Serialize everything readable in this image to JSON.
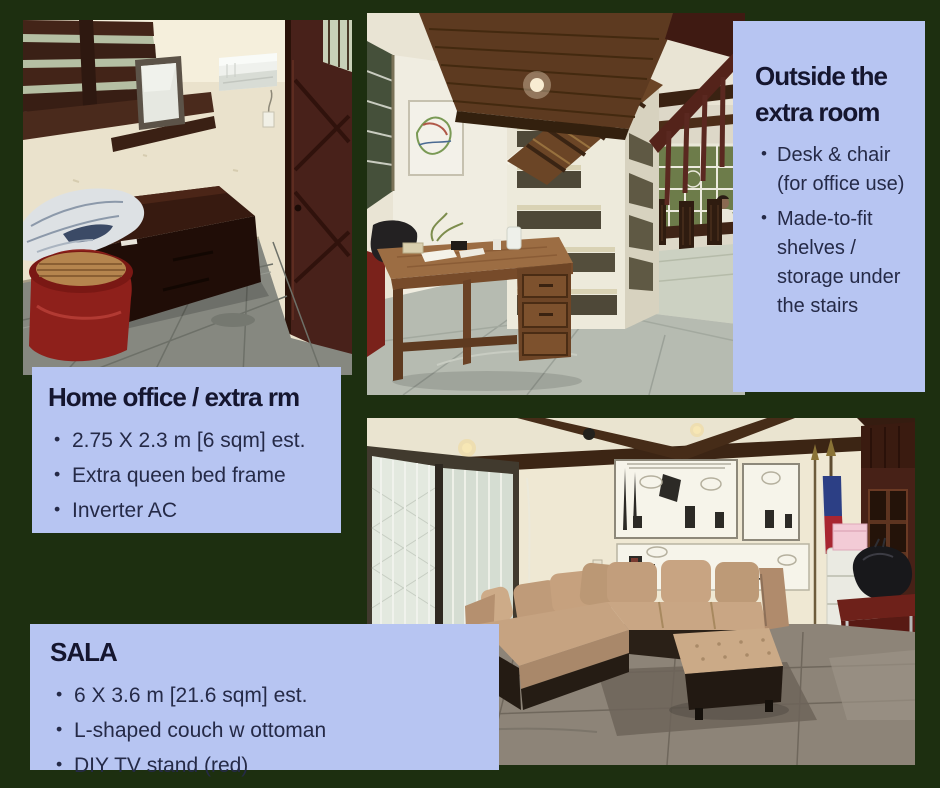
{
  "page": {
    "background_color": "#1d2f10",
    "panel_color": "#b7c5f2",
    "title_color": "#15162f",
    "bullet_color": "#252a47"
  },
  "sections": {
    "outside": {
      "title": "Outside the extra room",
      "bullets": [
        "Desk & chair (for office use)",
        "Made-to-fit shelves / storage under the stairs"
      ]
    },
    "office": {
      "title": "Home office / extra rm",
      "bullets": [
        "2.75 X 2.3 m [6 sqm] est.",
        "Extra queen bed frame",
        "Inverter AC"
      ]
    },
    "sala": {
      "title": "SALA",
      "bullets": [
        "6 X 3.6 m [21.6 sqm] est.",
        "L-shaped couch w ottoman",
        "DIY TV stand (red)"
      ]
    }
  },
  "photos": {
    "extra_room": {
      "label": "Extra room photo: dark wood bed frame, wall shelves, inverter AC, wooden door, red drum table"
    },
    "under_stairs": {
      "label": "Outside the extra room photo: wooden desk, white made-to-fit shelves under the stairs, dining area behind"
    },
    "sala": {
      "label": "Sala photo: L-shaped tan couch with ottoman, comic posters, windows, flag and red stand"
    }
  }
}
